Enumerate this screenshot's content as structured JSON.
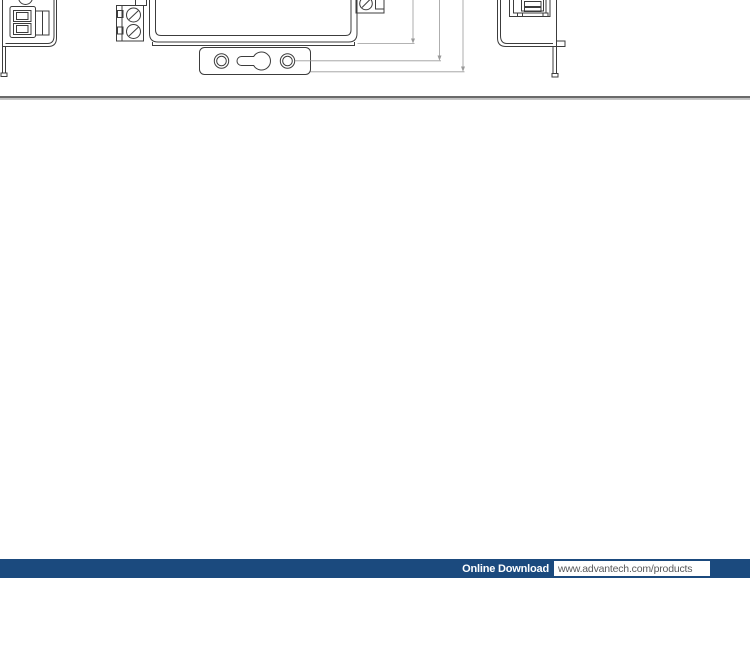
{
  "drawing_section": {
    "figures": [
      {
        "name": "left-side-view",
        "description": "Device left side view with 2-pin terminal plug (cut off at page top)"
      },
      {
        "name": "bottom-view",
        "description": "Device bottom view with screw terminal blocks and wall-mount bracket with keyhole slot"
      },
      {
        "name": "right-side-view",
        "description": "Device right side view with RJ45 port and mounting tab"
      }
    ],
    "line_color": "#3c3c3c",
    "dimension_line_color": "#9a9a9a",
    "dimension_arrows": 3
  },
  "divider": {
    "top_color": "#6a6a6a",
    "bottom_color": "#c9c9c9"
  },
  "footer": {
    "bar_color": "#1b4a7e",
    "label": "Online Download",
    "url": "www.advantech.com/products",
    "url_text_color": "#58595b"
  }
}
